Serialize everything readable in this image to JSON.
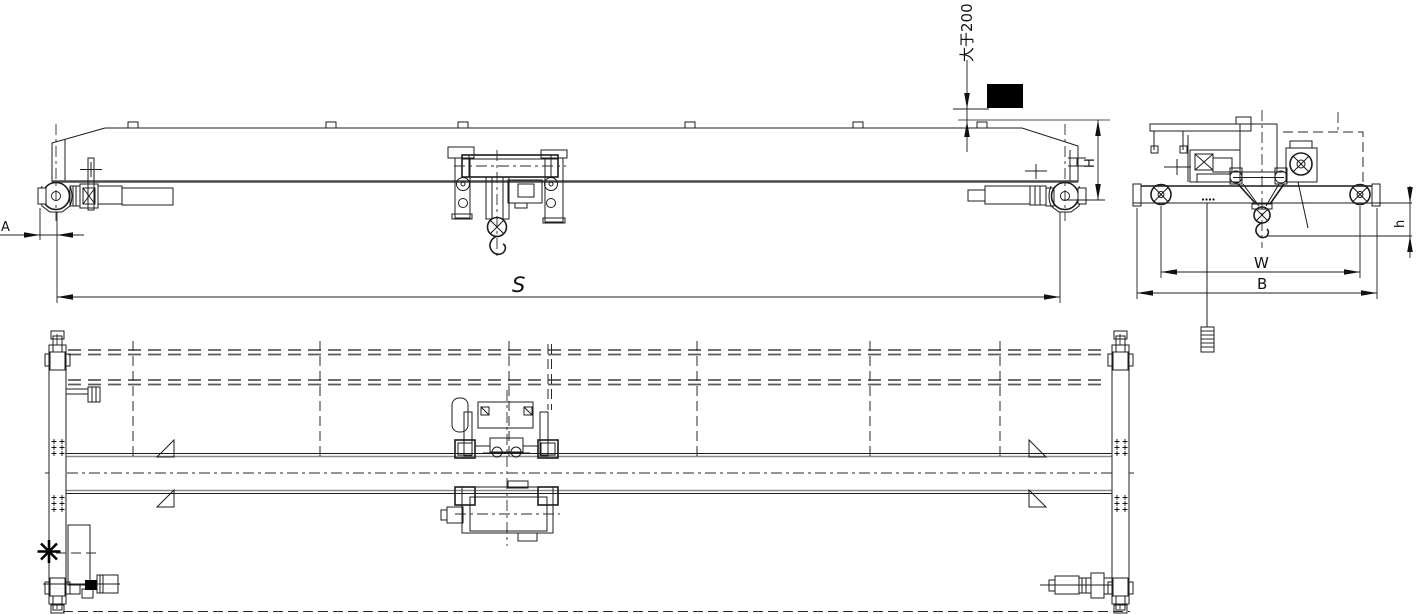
{
  "drawing": {
    "labels": {
      "top_clearance": "大于200",
      "crane_height": "H",
      "span": "S",
      "hook_approach": "A",
      "trolley_wheelbase": "W",
      "end_carriage_base": "B",
      "hook_headroom": "h"
    },
    "colors": {
      "line": "#1c1c1c",
      "heavy_line": "#4a4a4a",
      "gray_line": "#8a8a8a",
      "solid_block": "#000000",
      "background": "#ffffff"
    }
  }
}
